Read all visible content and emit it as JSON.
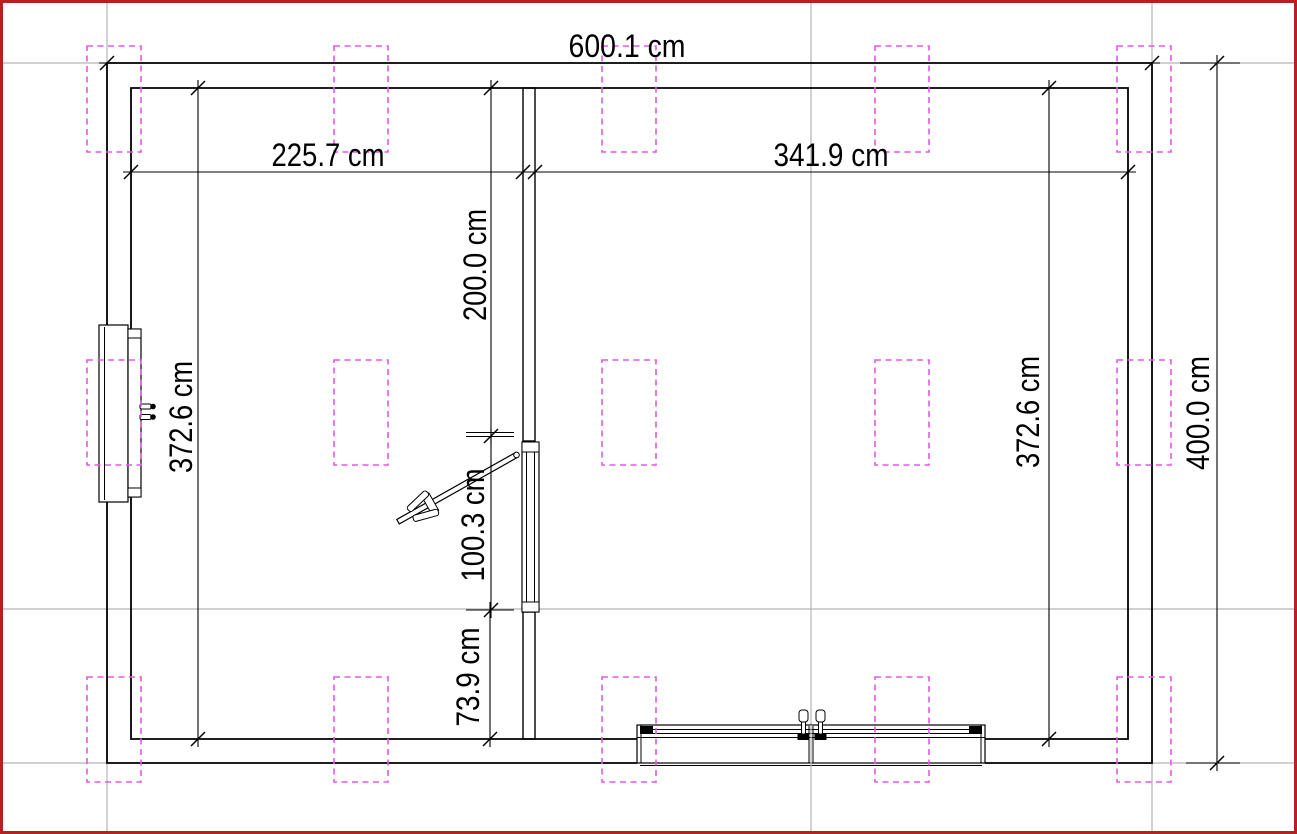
{
  "plan": {
    "unit": "cm",
    "dimensions": [
      {
        "id": "total-width",
        "label": "600.1 cm"
      },
      {
        "id": "left-room-width",
        "label": "225.7 cm"
      },
      {
        "id": "right-room-width",
        "label": "341.9 cm"
      },
      {
        "id": "left-room-depth",
        "label": "372.6 cm"
      },
      {
        "id": "door-offset-top",
        "label": "200.0 cm"
      },
      {
        "id": "door-opening-width",
        "label": "100.3 cm"
      },
      {
        "id": "door-offset-bottom",
        "label": "73.9 cm"
      },
      {
        "id": "right-room-depth",
        "label": "372.6 cm"
      },
      {
        "id": "total-height",
        "label": "400.0 cm"
      }
    ],
    "colors": {
      "page_border": "#b32222",
      "construction_lines": "#b5b5b5",
      "fixture_dashed": "#e359e3",
      "line_work": "#000000",
      "background": "#ffffff"
    }
  }
}
